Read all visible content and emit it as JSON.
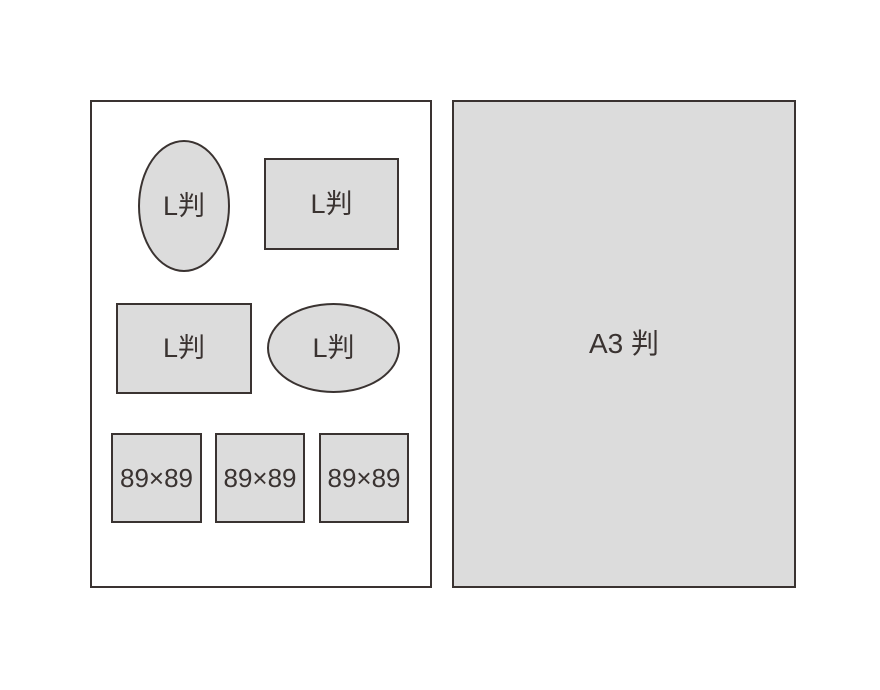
{
  "diagram": {
    "description_hint": "print size comparison diagram",
    "left_panel": {
      "shapes": [
        {
          "kind": "ellipse-portrait",
          "label": "L判"
        },
        {
          "kind": "rectangle-landscape-top",
          "label": "L判"
        },
        {
          "kind": "rectangle-landscape-middle",
          "label": "L判"
        },
        {
          "kind": "ellipse-landscape",
          "label": "L判"
        },
        {
          "kind": "square",
          "label": "89×89"
        },
        {
          "kind": "square",
          "label": "89×89"
        },
        {
          "kind": "square",
          "label": "89×89"
        }
      ]
    },
    "right_panel": {
      "label": "A3 判"
    }
  },
  "colors": {
    "shape_fill": "#dcdcdc",
    "stroke": "#3a3331",
    "background": "#ffffff"
  }
}
